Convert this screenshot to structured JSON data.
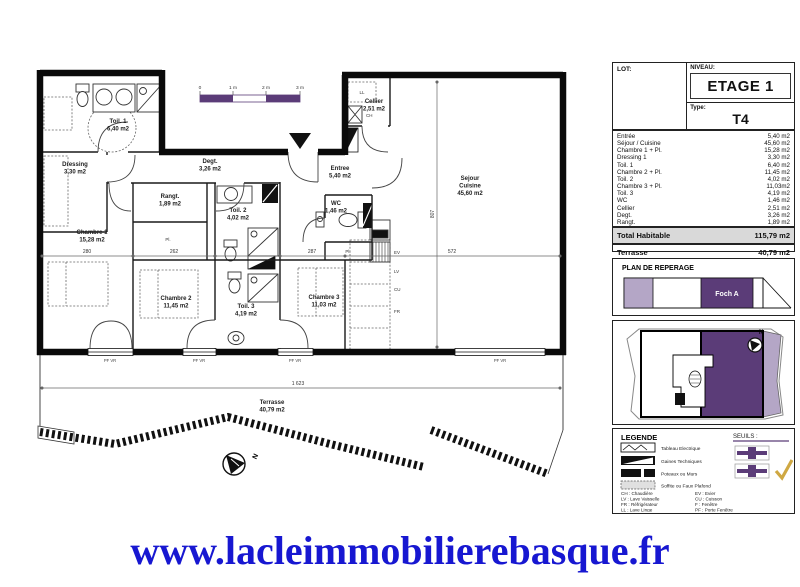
{
  "plan": {
    "scale_bar": {
      "t0": "0",
      "t1": "1 m",
      "t2": "2 m",
      "t3": "3 m"
    },
    "north": "N",
    "rooms": {
      "toil1": {
        "name": "Toil. 1",
        "area": "6,40 m2"
      },
      "dressing": {
        "name": "Dressing",
        "area": "3,30 m2"
      },
      "chambre1": {
        "name": "Chambre 1",
        "area": "15,28 m2"
      },
      "rangt": {
        "name": "Rangt.",
        "area": "1,89 m2"
      },
      "degt": {
        "name": "Degt.",
        "area": "3,26 m2"
      },
      "toil2": {
        "name": "Toil. 2",
        "area": "4,02 m2"
      },
      "entree": {
        "name": "Entree",
        "area": "5,40 m2"
      },
      "wc": {
        "name": "WC",
        "area": "1,46 m2"
      },
      "cellier": {
        "name": "Cellier",
        "area": "2,51 m2"
      },
      "sejour": {
        "line1": "Sejour",
        "line2": "Cuisine",
        "area": "45,60 m2"
      },
      "chambre2": {
        "name": "Chambre 2",
        "area": "11,45 m2"
      },
      "toil3": {
        "name": "Toil. 3",
        "area": "4,19 m2"
      },
      "chambre3": {
        "name": "Chambre 3",
        "area": "11,03 m2"
      },
      "terrasse": {
        "name": "Terrasse",
        "area": "40,79 m2"
      }
    },
    "fixture_labels": {
      "ll": "LL",
      "ch": "CH",
      "ev": "EV",
      "lv": "LV",
      "cu": "CU",
      "fr": "FR",
      "pl": "Pl.",
      "pfvr": "PF VR"
    },
    "dims": {
      "d280": "280",
      "d262": "262",
      "d287": "287",
      "d572": "572",
      "d1623": "1 623",
      "d807": "807"
    }
  },
  "info_panel": {
    "lot_label": "LOT:",
    "niveau_label": "NIVEAU:",
    "niveau_value": "ETAGE 1",
    "type_label": "Type:",
    "type_value": "T4",
    "rooms": [
      {
        "name": "Entrée",
        "area": "5,40 m2"
      },
      {
        "name": "Séjour / Cuisine",
        "area": "45,60 m2"
      },
      {
        "name": "Chambre 1 + Pl.",
        "area": "15,28 m2"
      },
      {
        "name": "Dressing 1",
        "area": "3,30 m2"
      },
      {
        "name": "Toil. 1",
        "area": "6,40 m2"
      },
      {
        "name": "Chambre 2 + Pl.",
        "area": "11,45 m2"
      },
      {
        "name": "Toil. 2",
        "area": "4,02 m2"
      },
      {
        "name": "Chambre 3 + Pl.",
        "area": "11,03m2"
      },
      {
        "name": "Toil. 3",
        "area": "4,19 m2"
      },
      {
        "name": "WC",
        "area": "1,46 m2"
      },
      {
        "name": "Cellier",
        "area": "2,51 m2"
      },
      {
        "name": "Degt.",
        "area": "3,26 m2"
      },
      {
        "name": "Rangt.",
        "area": "1,89 m2"
      }
    ],
    "total_label": "Total Habitable",
    "total_value": "115,79 m2",
    "terrasse_label": "Terrasse",
    "terrasse_value": "40,79 m2"
  },
  "reperage": {
    "title": "PLAN DE REPERAGE",
    "block_label": "Foch A",
    "north": "N"
  },
  "legende": {
    "title": "LEGENDE",
    "seuils_label": "SEUILS :",
    "items": [
      "Tableau Electrique",
      "Gaines Techniques",
      "Poteaux ou Murs",
      "Soffite ou Faux Plafond"
    ],
    "abbr_left": [
      "CH : Chaudière",
      "LV : Lave Vaisselle",
      "FR : Réfrigérateur",
      "LL : Lave Linge",
      "PL : Placard"
    ],
    "abbr_right": [
      "EV : Evier",
      "CU : Cuisson",
      "F : Fenêtre",
      "PF : Porte Fenêtre",
      "VR : Volet Roulant"
    ]
  },
  "footer": {
    "url": "www.lacleimmobilierebasque.fr"
  },
  "colors": {
    "purple": "#5b3c78",
    "lavender": "#b4a6c6",
    "url_blue": "#1717d1",
    "check_gold": "#cfa843",
    "total_bg": "#d9d9d9"
  }
}
